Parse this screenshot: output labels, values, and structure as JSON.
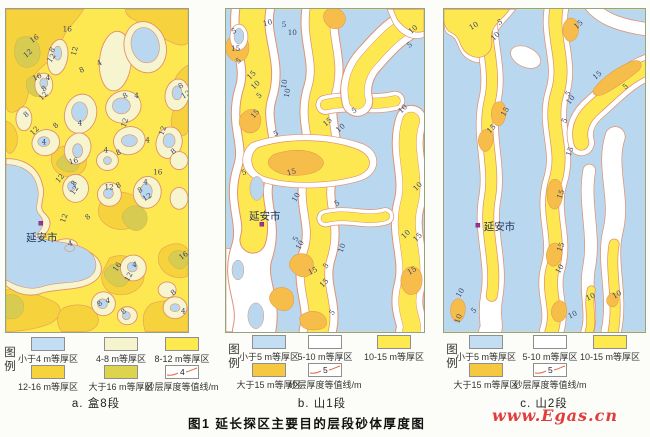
{
  "figure": {
    "caption": "图1  延长探区主要目的层段砂体厚度图",
    "watermark": "www.Egas.cn"
  },
  "palette": {
    "thin_blue": "#c3ddf2",
    "cream": "#f6f4cf",
    "yellow": "#fdea51",
    "gold": "#f6d23c",
    "olive": "#ded34c",
    "orange": "#f6c83f",
    "contour_line": "#df9270",
    "city_marker": "#9f3392"
  },
  "panels": [
    {
      "id": "a",
      "caption": "a. 盒8段",
      "city": {
        "name": "延安市"
      },
      "legend": {
        "title": "图例",
        "items": [
          {
            "label": "小于4 m等厚区",
            "color": "#c3ddf2"
          },
          {
            "label": "4-8 m等厚区",
            "color": "#f6f4cf"
          },
          {
            "label": "8-12 m等厚区",
            "color": "#fdea51"
          },
          {
            "label": "12-16 m等厚区",
            "color": "#f6d23c"
          },
          {
            "label": "大于16 m等厚区",
            "color": "#ded34c"
          }
        ],
        "contour_sample": {
          "value": "4",
          "label": "砂层厚度等值线/m"
        }
      },
      "labels": [
        [
          "16",
          57,
          22,
          0
        ],
        [
          "16",
          26,
          34,
          -35
        ],
        [
          "12",
          20,
          49,
          -40
        ],
        [
          "8",
          47,
          44,
          -55
        ],
        [
          "12",
          45,
          54,
          -55
        ],
        [
          "12",
          70,
          47,
          -75
        ],
        [
          "8",
          75,
          64,
          -25
        ],
        [
          "4",
          93,
          57,
          -30
        ],
        [
          "16",
          28,
          72,
          -25
        ],
        [
          "4",
          40,
          71,
          0
        ],
        [
          "8",
          38,
          83,
          -40
        ],
        [
          "12",
          36,
          92,
          -45
        ],
        [
          "8",
          20,
          109,
          -40
        ],
        [
          "8",
          119,
          90,
          -30
        ],
        [
          "4",
          129,
          89,
          0
        ],
        [
          "8",
          175,
          80,
          -30
        ],
        [
          "12",
          178,
          90,
          -30
        ],
        [
          "4",
          72,
          117,
          0
        ],
        [
          "8",
          50,
          120,
          -45
        ],
        [
          "12",
          120,
          119,
          -70
        ],
        [
          "12",
          27,
          127,
          -45
        ],
        [
          "4",
          36,
          136,
          0
        ],
        [
          "12",
          158,
          127,
          -70
        ],
        [
          "4",
          140,
          134,
          0
        ],
        [
          "8",
          112,
          147,
          -25
        ],
        [
          "4",
          98,
          144,
          0
        ],
        [
          "16",
          64,
          156,
          -15
        ],
        [
          "8",
          168,
          146,
          -40
        ],
        [
          "12",
          53,
          175,
          -50
        ],
        [
          "8",
          69,
          178,
          -55
        ],
        [
          "12",
          68,
          187,
          -55
        ],
        [
          "12",
          99,
          181,
          0
        ],
        [
          "8",
          112,
          180,
          -25
        ],
        [
          "16",
          148,
          166,
          0
        ],
        [
          "4",
          138,
          176,
          0
        ],
        [
          "8",
          134,
          185,
          -30
        ],
        [
          "12",
          139,
          193,
          -30
        ],
        [
          "12",
          59,
          215,
          -70
        ],
        [
          "8",
          82,
          212,
          -40
        ],
        [
          "4",
          63,
          238,
          -15
        ],
        [
          "16",
          111,
          264,
          -55
        ],
        [
          "4",
          127,
          259,
          0
        ],
        [
          "12",
          123,
          274,
          -60
        ],
        [
          "16",
          176,
          252,
          -35
        ],
        [
          "8",
          168,
          288,
          -40
        ],
        [
          "4",
          100,
          295,
          0
        ],
        [
          "8",
          94,
          299,
          -40
        ],
        [
          "8",
          118,
          307,
          -40
        ],
        [
          "4",
          176,
          306,
          0
        ]
      ]
    },
    {
      "id": "b",
      "caption": "b. 山1段",
      "city": {
        "name": "延安市"
      },
      "legend": {
        "title": "图例",
        "items": [
          {
            "label": "小于5 m等厚区",
            "color": "#c3ddf2"
          },
          {
            "label": "5-10 m等厚区",
            "color": "#ffffff"
          },
          {
            "label": "10-15 m等厚区",
            "color": "#fdea51"
          },
          {
            "label": "大于15 m等厚区",
            "color": "#f6c83f"
          }
        ],
        "contour_sample": {
          "value": "5",
          "label": "砂层厚度等值线/m"
        }
      },
      "labels": [
        [
          "5",
          7,
          25,
          -25
        ],
        [
          "10",
          38,
          17,
          -15
        ],
        [
          "5",
          56,
          18,
          0
        ],
        [
          "10",
          62,
          26,
          0
        ],
        [
          "15",
          5,
          42,
          0
        ],
        [
          "5",
          12,
          55,
          -35
        ],
        [
          "10",
          186,
          25,
          -40
        ],
        [
          "5",
          184,
          39,
          -35
        ],
        [
          "15",
          24,
          71,
          -45
        ],
        [
          "10",
          28,
          81,
          -45
        ],
        [
          "5",
          33,
          90,
          -40
        ],
        [
          "10",
          60,
          80,
          -80
        ],
        [
          "10",
          63,
          89,
          -80
        ],
        [
          "15",
          28,
          110,
          -50
        ],
        [
          "5",
          49,
          128,
          -25
        ],
        [
          "5",
          128,
          105,
          -30
        ],
        [
          "15",
          100,
          118,
          -40
        ],
        [
          "10",
          113,
          124,
          -40
        ],
        [
          "10",
          176,
          105,
          -45
        ],
        [
          "5",
          17,
          167,
          -25
        ],
        [
          "15",
          62,
          167,
          -15
        ],
        [
          "10",
          70,
          194,
          -60
        ],
        [
          "5",
          111,
          198,
          -35
        ],
        [
          "10",
          191,
          183,
          -45
        ],
        [
          "5",
          71,
          234,
          -60
        ],
        [
          "10",
          74,
          242,
          -60
        ],
        [
          "10",
          179,
          231,
          -45
        ],
        [
          "15",
          191,
          234,
          -45
        ],
        [
          "10",
          117,
          245,
          -70
        ],
        [
          "15",
          84,
          267,
          -25
        ],
        [
          "5",
          101,
          261,
          -55
        ],
        [
          "15",
          184,
          267,
          -30
        ],
        [
          "15",
          97,
          280,
          -45
        ],
        [
          "5",
          107,
          308,
          -50
        ]
      ]
    },
    {
      "id": "c",
      "caption": "c. 山2段",
      "city": {
        "name": "延安市"
      },
      "legend": {
        "title": "图例",
        "items": [
          {
            "label": "小于5 m等厚区",
            "color": "#c3ddf2"
          },
          {
            "label": "5-10 m等厚区",
            "color": "#ffffff"
          },
          {
            "label": "10-15 m等厚区",
            "color": "#fdea51"
          },
          {
            "label": "大于15 m等厚区",
            "color": "#f6c83f"
          }
        ],
        "contour_sample": {
          "value": "5",
          "label": "砂层厚度等值线/m"
        }
      },
      "labels": [
        [
          "10",
          27,
          21,
          -30
        ],
        [
          "5",
          55,
          16,
          -25
        ],
        [
          "10",
          50,
          32,
          -45
        ],
        [
          "15",
          133,
          20,
          -40
        ],
        [
          "15",
          152,
          71,
          -40
        ],
        [
          "5",
          182,
          81,
          -40
        ],
        [
          "5",
          125,
          88,
          -50
        ],
        [
          "10",
          126,
          96,
          -50
        ],
        [
          "15",
          61,
          108,
          -60
        ],
        [
          "15",
          46,
          125,
          -45
        ],
        [
          "5",
          122,
          115,
          -60
        ],
        [
          "15",
          127,
          148,
          -70
        ],
        [
          "15",
          118,
          191,
          -70
        ],
        [
          "15",
          118,
          244,
          -70
        ],
        [
          "10",
          116,
          266,
          -60
        ],
        [
          "10",
          16,
          290,
          -60
        ],
        [
          "5",
          30,
          306,
          -45
        ],
        [
          "10",
          15,
          316,
          -70
        ],
        [
          "10",
          144,
          293,
          -25
        ],
        [
          "10",
          171,
          291,
          -30
        ],
        [
          "10",
          126,
          311,
          -25
        ]
      ]
    }
  ]
}
